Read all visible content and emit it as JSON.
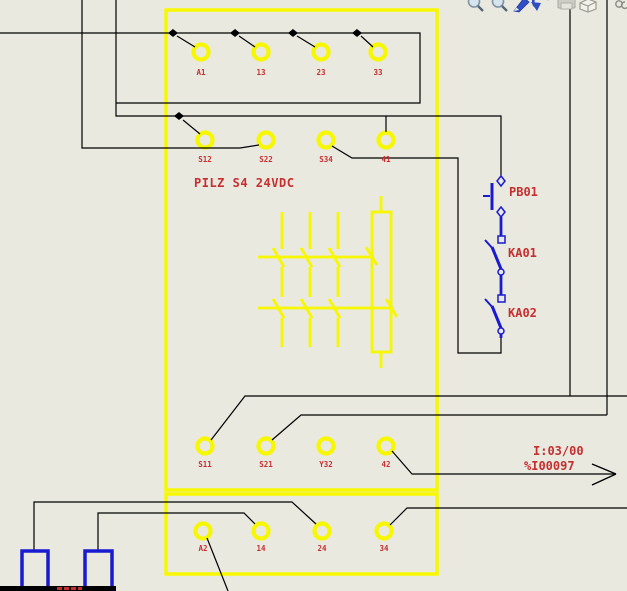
{
  "colors": {
    "background": "#e9e9e0",
    "relay_yellow": "#f7f700",
    "label_red": "#c52f2f",
    "device_blue": "#1a1ad1",
    "wire_black": "#000000"
  },
  "toolbar": {
    "icons": [
      {
        "name": "zoom-in"
      },
      {
        "name": "zoom-window"
      },
      {
        "name": "pen"
      },
      {
        "name": "undo"
      },
      {
        "name": "print"
      },
      {
        "name": "cube"
      },
      {
        "name": "partial-icon"
      }
    ]
  },
  "relay": {
    "title": "PILZ S4 24VDC",
    "rows": [
      {
        "labels": [
          "A1",
          "13",
          "23",
          "33"
        ]
      },
      {
        "labels": [
          "S12",
          "S22",
          "S34",
          "41"
        ]
      },
      {
        "labels": [
          "S11",
          "S21",
          "Y32",
          "42"
        ]
      },
      {
        "labels": [
          "A2",
          "14",
          "24",
          "34"
        ]
      }
    ]
  },
  "devices": [
    {
      "label": "PB01",
      "type": "nc-pushbutton"
    },
    {
      "label": "KA01",
      "type": "relay-contact"
    },
    {
      "label": "KA02",
      "type": "relay-contact"
    }
  ],
  "io": {
    "address": "I:03/00",
    "tag": "%I00097"
  }
}
